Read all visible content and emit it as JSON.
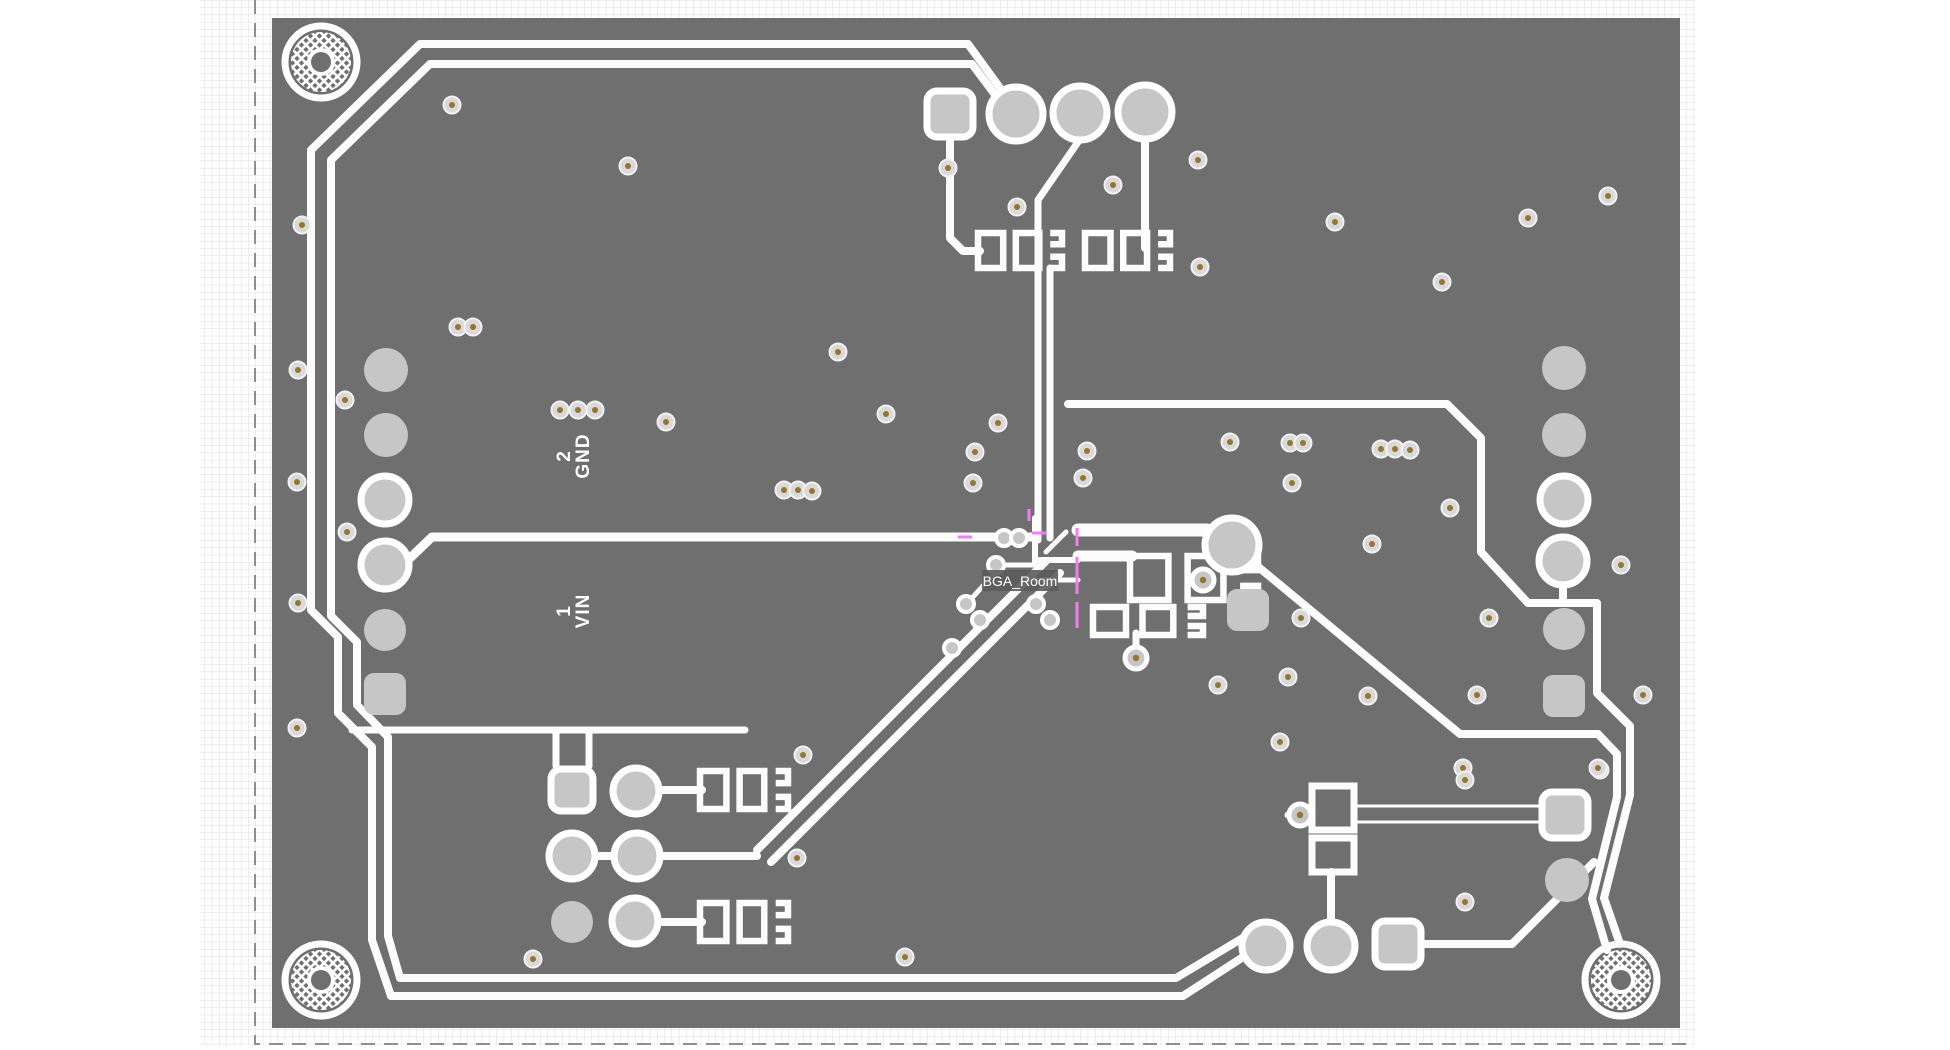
{
  "view": {
    "type": "pcb-layout-canvas",
    "width": 1950,
    "height": 1050
  },
  "colors": {
    "background": "#ffffff",
    "grid_line": "#dcdcdc",
    "sheet_border": "#8f8f8f",
    "board": "#6f6f6f",
    "trace": "#fcfcfc",
    "pad_fill": "#c6c6c6",
    "pad_ring": "#ffffff",
    "via_body": "#d9d9d9",
    "via_ring": "#f2f2f2",
    "via_center": "#96752e",
    "room_line": "#f27df2",
    "label_text": "#ffffff",
    "room_label_bg": "#5b5b5b"
  },
  "sheet": {
    "x": 200,
    "y": 0,
    "w": 1495,
    "h": 1045,
    "grid_step": 7.3,
    "dash_border": "M 255 0 V 1044 H 1695"
  },
  "board": {
    "x": 272,
    "y": 18,
    "w": 1408,
    "h": 1010
  },
  "labels": {
    "plane2": {
      "num": "2",
      "net": "GND",
      "x": 570,
      "y": 456
    },
    "plane1": {
      "num": "1",
      "net": "VIN",
      "x": 570,
      "y": 611
    },
    "room": {
      "text": "BGA_Room",
      "x": 1020,
      "y": 586,
      "box": [
        982,
        570,
        76,
        21
      ]
    }
  },
  "mounting_holes": [
    {
      "x": 321,
      "y": 62
    },
    {
      "x": 321,
      "y": 980
    },
    {
      "x": 1621,
      "y": 980
    }
  ],
  "traces": [
    {
      "d": "M 1016 110 L 968 44 H 420 L 311 150 V 610 L 338 637 V 713 L 372 747 V 940 L 391 996 H 1183 L 1260 946",
      "w": 8
    },
    {
      "d": "M 1014 120 L 972 64 H 430 L 331 160 V 616 L 357 642 V 705 L 388 737 V 936 L 400 978 H 1176 L 1246 936",
      "w": 8
    },
    {
      "d": "M 408 560 L 432 537 H 1035",
      "w": 9
    },
    {
      "d": "M 352 730 H 745",
      "w": 7
    },
    {
      "d": "M 556 733 V 766",
      "w": 7
    },
    {
      "d": "M 589 733 V 766",
      "w": 7
    },
    {
      "d": "M 1078 142 L 1038 200 V 540",
      "w": 7
    },
    {
      "d": "M 1050 268 V 538",
      "w": 7
    },
    {
      "d": "M 950 142 V 238 L 963 251 H 980",
      "w": 8
    },
    {
      "d": "M 1145 140 V 248",
      "w": 8
    },
    {
      "d": "M 1068 404 H 1447 L 1481 438 V 552 L 1528 603 H 1597 V 693 L 1630 726 V 795 L 1604 898 L 1620 944",
      "w": 8
    },
    {
      "d": "M 1598 734 L 1617 754 V 797 L 1592 899 L 1607 950",
      "w": 8
    },
    {
      "d": "M 1250 560 L 1460 734 L 1598 734",
      "w": 8
    },
    {
      "d": "M 1563 585 V 603",
      "w": 8
    },
    {
      "d": "M 1078 530 H 1207",
      "w": 13
    },
    {
      "d": "M 1078 556 H 1132",
      "w": 11
    },
    {
      "d": "M 1331 872 V 922",
      "w": 8
    },
    {
      "d": "M 1424 944 H 1512 L 1594 862",
      "w": 8
    },
    {
      "d": "M 658 790 H 702",
      "w": 8
    },
    {
      "d": "M 594 856 H 614",
      "w": 8
    },
    {
      "d": "M 660 856 H 757",
      "w": 8
    },
    {
      "d": "M 658 922 H 702",
      "w": 8
    },
    {
      "d": "M 757 850 L 1046 561",
      "w": 8
    },
    {
      "d": "M 771 862 L 1060 573",
      "w": 8
    },
    {
      "d": "M 1136 633 V 650",
      "w": 7
    },
    {
      "d": "M 1288 815 H 1312",
      "w": 7
    },
    {
      "d": "M 1035 518 V 562",
      "w": 6
    },
    {
      "d": "M 990 537 H 1035",
      "w": 6
    },
    {
      "d": "M 1035 560 H 1078",
      "w": 6
    },
    {
      "d": "M 1035 565 L 1002 565 L 972 598",
      "w": 5
    },
    {
      "d": "M 1022 583 L 992 614",
      "w": 5
    },
    {
      "d": "M 1035 580 H 1078",
      "w": 5
    },
    {
      "d": "M 1046 552 L 1066 532",
      "w": 5
    }
  ],
  "hollow_traces": [
    {
      "d": "M 1352 806 H 1542",
      "w": 3
    },
    {
      "d": "M 1352 822 H 1542",
      "w": 3
    }
  ],
  "footprints": [
    {
      "x": 978,
      "y": 233,
      "w": 84,
      "h": 35
    },
    {
      "x": 1085,
      "y": 233,
      "w": 85,
      "h": 35
    },
    {
      "x": 700,
      "y": 771,
      "w": 88,
      "h": 38
    },
    {
      "x": 700,
      "y": 903,
      "w": 88,
      "h": 38
    },
    {
      "x": 1130,
      "y": 556,
      "w": 128,
      "h": 44
    },
    {
      "x": 1093,
      "y": 607,
      "w": 110,
      "h": 28
    }
  ],
  "rect_outlines": [
    {
      "x": 1312,
      "y": 786,
      "w": 42,
      "h": 44
    },
    {
      "x": 1312,
      "y": 838,
      "w": 42,
      "h": 34
    }
  ],
  "pads": [
    {
      "shape": "rsq",
      "x": 950,
      "y": 114,
      "s": 46,
      "ring": true
    },
    {
      "shape": "circle",
      "x": 1016,
      "y": 114,
      "r": 27,
      "ring": true
    },
    {
      "shape": "circle",
      "x": 1080,
      "y": 113,
      "r": 27,
      "ring": true
    },
    {
      "shape": "circle",
      "x": 1145,
      "y": 112,
      "r": 27,
      "ring": true
    },
    {
      "shape": "circle",
      "x": 386,
      "y": 370,
      "r": 22,
      "ring": false
    },
    {
      "shape": "circle",
      "x": 386,
      "y": 435,
      "r": 22,
      "ring": false
    },
    {
      "shape": "circle",
      "x": 385,
      "y": 500,
      "r": 24,
      "ring": true
    },
    {
      "shape": "circle",
      "x": 385,
      "y": 565,
      "r": 24,
      "ring": true
    },
    {
      "shape": "circle",
      "x": 385,
      "y": 630,
      "r": 21,
      "ring": false
    },
    {
      "shape": "rsq",
      "x": 385,
      "y": 694,
      "s": 42,
      "ring": false
    },
    {
      "shape": "circle",
      "x": 1564,
      "y": 368,
      "r": 22,
      "ring": false
    },
    {
      "shape": "circle",
      "x": 1564,
      "y": 435,
      "r": 22,
      "ring": false
    },
    {
      "shape": "circle",
      "x": 1564,
      "y": 500,
      "r": 24,
      "ring": true
    },
    {
      "shape": "circle",
      "x": 1563,
      "y": 561,
      "r": 24,
      "ring": true
    },
    {
      "shape": "circle",
      "x": 1564,
      "y": 629,
      "r": 21,
      "ring": false
    },
    {
      "shape": "rsq",
      "x": 1564,
      "y": 696,
      "s": 42,
      "ring": false
    },
    {
      "shape": "circle",
      "x": 1232,
      "y": 545,
      "r": 27,
      "ring": true
    },
    {
      "shape": "rsq",
      "x": 1248,
      "y": 610,
      "s": 42,
      "ring": false
    },
    {
      "shape": "rsq",
      "x": 572,
      "y": 790,
      "s": 42,
      "ring": true
    },
    {
      "shape": "circle",
      "x": 636,
      "y": 791,
      "r": 23,
      "ring": true
    },
    {
      "shape": "circle",
      "x": 572,
      "y": 856,
      "r": 23,
      "ring": true
    },
    {
      "shape": "circle",
      "x": 637,
      "y": 856,
      "r": 23,
      "ring": true
    },
    {
      "shape": "circle",
      "x": 572,
      "y": 922,
      "r": 21,
      "ring": false
    },
    {
      "shape": "circle",
      "x": 635,
      "y": 921,
      "r": 23,
      "ring": true
    },
    {
      "shape": "rsq",
      "x": 1565,
      "y": 815,
      "s": 46,
      "ring": true
    },
    {
      "shape": "circle",
      "x": 1567,
      "y": 880,
      "r": 22,
      "ring": false
    },
    {
      "shape": "circle",
      "x": 1266,
      "y": 946,
      "r": 24,
      "ring": true
    },
    {
      "shape": "circle",
      "x": 1331,
      "y": 946,
      "r": 24,
      "ring": true
    },
    {
      "shape": "rsq",
      "x": 1398,
      "y": 944,
      "s": 46,
      "ring": true
    }
  ],
  "viapads": [
    [
      1300,
      815
    ],
    [
      1203,
      580
    ],
    [
      1136,
      658
    ]
  ],
  "minipads": [
    [
      1004,
      538
    ],
    [
      1019,
      538
    ],
    [
      996,
      565
    ],
    [
      966,
      604
    ],
    [
      980,
      620
    ],
    [
      952,
      648
    ],
    [
      1036,
      604
    ],
    [
      1050,
      620
    ]
  ],
  "vias": [
    [
      452,
      105
    ],
    [
      302,
      225
    ],
    [
      628,
      166
    ],
    [
      948,
      168
    ],
    [
      1113,
      185
    ],
    [
      1017,
      207
    ],
    [
      1198,
      160
    ],
    [
      1200,
      267
    ],
    [
      1608,
      196
    ],
    [
      1528,
      218
    ],
    [
      1335,
      222
    ],
    [
      1442,
      282
    ],
    [
      298,
      370
    ],
    [
      345,
      400
    ],
    [
      297,
      482
    ],
    [
      347,
      532
    ],
    [
      298,
      603
    ],
    [
      297,
      728
    ],
    [
      458,
      327
    ],
    [
      473,
      327
    ],
    [
      560,
      410
    ],
    [
      578,
      410
    ],
    [
      595,
      410
    ],
    [
      666,
      422
    ],
    [
      838,
      352
    ],
    [
      886,
      414
    ],
    [
      998,
      423
    ],
    [
      975,
      452
    ],
    [
      973,
      483
    ],
    [
      784,
      490
    ],
    [
      798,
      490
    ],
    [
      812,
      491
    ],
    [
      1087,
      451
    ],
    [
      1083,
      478
    ],
    [
      1230,
      442
    ],
    [
      1290,
      443
    ],
    [
      1303,
      443
    ],
    [
      1381,
      449
    ],
    [
      1395,
      449
    ],
    [
      1410,
      450
    ],
    [
      1292,
      483
    ],
    [
      1450,
      508
    ],
    [
      1372,
      544
    ],
    [
      1301,
      618
    ],
    [
      1489,
      618
    ],
    [
      1621,
      565
    ],
    [
      1477,
      695
    ],
    [
      1643,
      695
    ],
    [
      1600,
      770
    ],
    [
      1463,
      768
    ],
    [
      1218,
      685
    ],
    [
      1288,
      677
    ],
    [
      1368,
      696
    ],
    [
      803,
      755
    ],
    [
      797,
      858
    ],
    [
      533,
      959
    ],
    [
      905,
      957
    ],
    [
      1280,
      742
    ],
    [
      1465,
      780
    ],
    [
      1598,
      768
    ],
    [
      1465,
      902
    ]
  ],
  "room_segments": [
    [
      958,
      537,
      972,
      537
    ],
    [
      1029,
      509,
      1029,
      521
    ],
    [
      1032,
      533,
      1046,
      533
    ],
    [
      1077,
      528,
      1077,
      546
    ],
    [
      1077,
      557,
      1077,
      594
    ],
    [
      1077,
      602,
      1077,
      628
    ]
  ]
}
